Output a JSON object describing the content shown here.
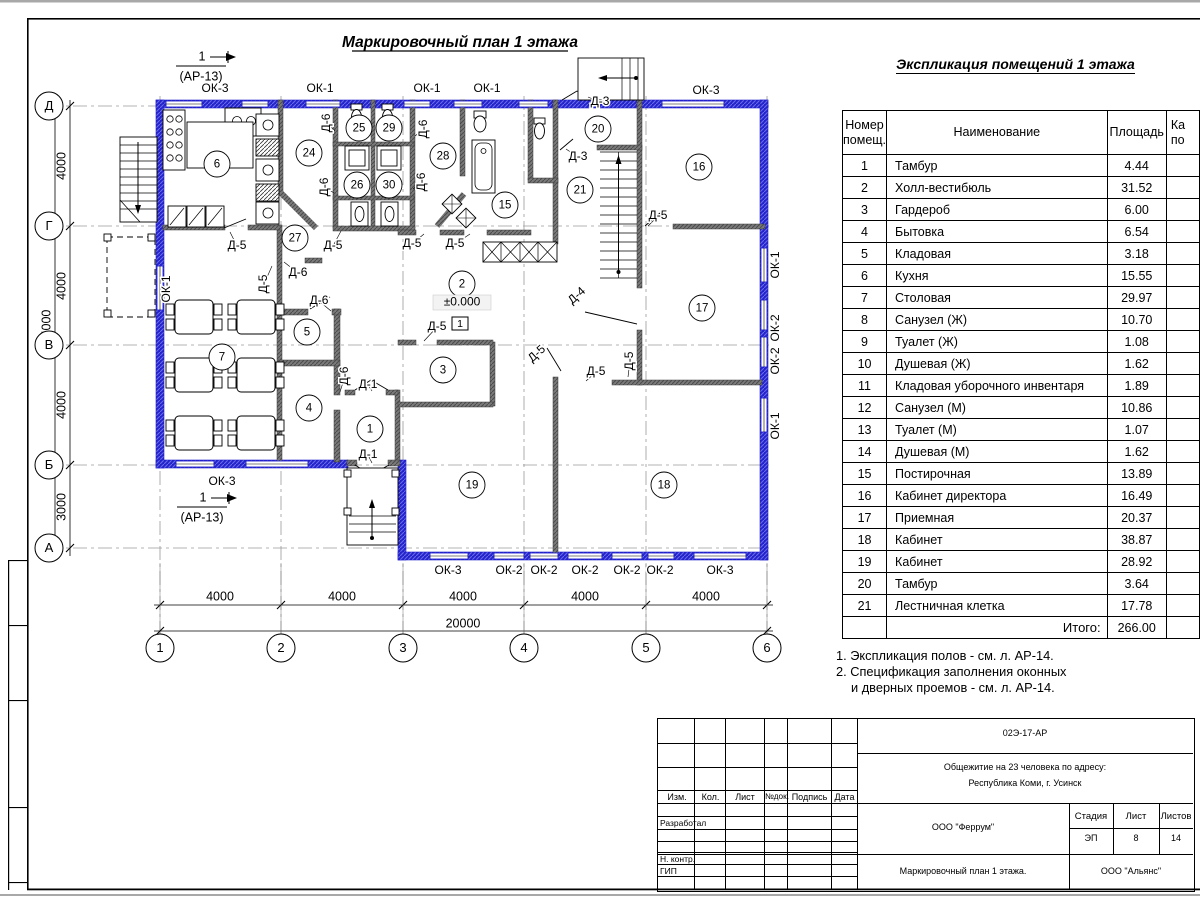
{
  "colors": {
    "wall_blue": "#2323cd",
    "wall_blue_light": "#6a6ae4",
    "wall_dark": "#7a7a7a",
    "wall_dark_line": "#4a4a4a",
    "line": "#000000",
    "axis": "#9a9a9a"
  },
  "plan": {
    "title": "Маркировочный план 1 этажа",
    "level_mark": "±0.000",
    "floor_mark": "1",
    "section_mark": {
      "num": "1",
      "ref": "(АР-13)"
    },
    "rooms": [
      {
        "n": "6",
        "x": 217,
        "y": 164
      },
      {
        "n": "24",
        "x": 309,
        "y": 153
      },
      {
        "n": "25",
        "x": 359,
        "y": 128
      },
      {
        "n": "29",
        "x": 389,
        "y": 128
      },
      {
        "n": "26",
        "x": 357,
        "y": 185
      },
      {
        "n": "30",
        "x": 389,
        "y": 185
      },
      {
        "n": "27",
        "x": 295,
        "y": 238
      },
      {
        "n": "28",
        "x": 443,
        "y": 156
      },
      {
        "n": "15",
        "x": 505,
        "y": 205
      },
      {
        "n": "2",
        "x": 462,
        "y": 284
      },
      {
        "n": "20",
        "x": 598,
        "y": 129
      },
      {
        "n": "21",
        "x": 580,
        "y": 190
      },
      {
        "n": "16",
        "x": 699,
        "y": 167
      },
      {
        "n": "17",
        "x": 702,
        "y": 308
      },
      {
        "n": "5",
        "x": 307,
        "y": 332
      },
      {
        "n": "7",
        "x": 222,
        "y": 357
      },
      {
        "n": "3",
        "x": 443,
        "y": 370
      },
      {
        "n": "4",
        "x": 309,
        "y": 408
      },
      {
        "n": "1",
        "x": 370,
        "y": 429
      },
      {
        "n": "19",
        "x": 472,
        "y": 485
      },
      {
        "n": "18",
        "x": 664,
        "y": 485
      }
    ],
    "labels": [
      {
        "t": "ОК-3",
        "x": 215,
        "y": 89
      },
      {
        "t": "ОК-1",
        "x": 320,
        "y": 89
      },
      {
        "t": "ОК-1",
        "x": 427,
        "y": 89
      },
      {
        "t": "ОК-1",
        "x": 487,
        "y": 89
      },
      {
        "t": "ОК-3",
        "x": 706,
        "y": 91
      },
      {
        "t": "ОК-1",
        "x": 167,
        "y": 289,
        "r": -90
      },
      {
        "t": "ОК-3",
        "x": 222,
        "y": 482
      },
      {
        "t": "ОК-3",
        "x": 448,
        "y": 571
      },
      {
        "t": "ОК-2",
        "x": 509,
        "y": 571
      },
      {
        "t": "ОК-2",
        "x": 544,
        "y": 571
      },
      {
        "t": "ОК-2",
        "x": 585,
        "y": 571
      },
      {
        "t": "ОК-2",
        "x": 627,
        "y": 571
      },
      {
        "t": "ОК-2",
        "x": 660,
        "y": 571
      },
      {
        "t": "ОК-3",
        "x": 720,
        "y": 571
      },
      {
        "t": "ОК-1",
        "x": 776,
        "y": 265,
        "r": -90
      },
      {
        "t": "ОК-2",
        "x": 776,
        "y": 328,
        "r": -90
      },
      {
        "t": "ОК-2",
        "x": 776,
        "y": 361,
        "r": -90
      },
      {
        "t": "ОК-1",
        "x": 776,
        "y": 426,
        "r": -90
      },
      {
        "t": "Д-6",
        "x": 327,
        "y": 123,
        "r": -90,
        "l": [
          335,
          131
        ]
      },
      {
        "t": "Д-6",
        "x": 325,
        "y": 187,
        "r": -90,
        "l": [
          334,
          193
        ]
      },
      {
        "t": "Д-6",
        "x": 424,
        "y": 129,
        "r": -90,
        "l": [
          415,
          136
        ]
      },
      {
        "t": "Д-6",
        "x": 422,
        "y": 182,
        "r": -90,
        "l": [
          413,
          189
        ]
      },
      {
        "t": "Д-5",
        "x": 237,
        "y": 246,
        "l": [
          230,
          232
        ]
      },
      {
        "t": "Д-5",
        "x": 264,
        "y": 284,
        "r": -90,
        "l": [
          272,
          266
        ]
      },
      {
        "t": "Д-5",
        "x": 333,
        "y": 246,
        "l": [
          341,
          231
        ]
      },
      {
        "t": "Д-5",
        "x": 412,
        "y": 244,
        "l": [
          424,
          234
        ]
      },
      {
        "t": "Д-5",
        "x": 455,
        "y": 244,
        "l": [
          470,
          234
        ]
      },
      {
        "t": "Д-6",
        "x": 298,
        "y": 273,
        "l": [
          284,
          262
        ]
      },
      {
        "t": "Д-6",
        "x": 319,
        "y": 301,
        "l": [
          331,
          311
        ]
      },
      {
        "t": "Д-6",
        "x": 345,
        "y": 376,
        "r": -90,
        "l": [
          340,
          392
        ]
      },
      {
        "t": "Д-1",
        "x": 368,
        "y": 385,
        "l": [
          372,
          391
        ]
      },
      {
        "t": "Д-1",
        "x": 368,
        "y": 455,
        "l": [
          372,
          463
        ]
      },
      {
        "t": "Д-3",
        "x": 600,
        "y": 102,
        "l": [
          588,
          97
        ]
      },
      {
        "t": "Д-3",
        "x": 578,
        "y": 157,
        "l": [
          566,
          149
        ]
      },
      {
        "t": "Д-5",
        "x": 658,
        "y": 216,
        "l": [
          648,
          226
        ]
      },
      {
        "t": "Д-4",
        "x": 577,
        "y": 296,
        "r": -42
      },
      {
        "t": "Д-5",
        "x": 437,
        "y": 327,
        "l": [
          424,
          341
        ]
      },
      {
        "t": "Д-5",
        "x": 537,
        "y": 354,
        "r": -42
      },
      {
        "t": "Д-5",
        "x": 596,
        "y": 372,
        "l": [
          586,
          381
        ]
      },
      {
        "t": "Д-5",
        "x": 630,
        "y": 361,
        "r": -90,
        "l": [
          628,
          377
        ]
      }
    ],
    "axes_rows": [
      {
        "t": "Д",
        "y": 106
      },
      {
        "t": "Г",
        "y": 226
      },
      {
        "t": "В",
        "y": 345
      },
      {
        "t": "Б",
        "y": 465
      },
      {
        "t": "А",
        "y": 548
      }
    ],
    "axes_cols": [
      {
        "t": "1",
        "x": 160
      },
      {
        "t": "2",
        "x": 281
      },
      {
        "t": "3",
        "x": 403
      },
      {
        "t": "4",
        "x": 524
      },
      {
        "t": "5",
        "x": 646
      },
      {
        "t": "6",
        "x": 767
      }
    ],
    "dims_left": [
      {
        "t": "4000",
        "y": 166
      },
      {
        "t": "4000",
        "y": 286
      },
      {
        "t": "4000",
        "y": 405
      },
      {
        "t": "3000",
        "y": 507
      }
    ],
    "dim_left_total": "15000",
    "dims_bottom": [
      {
        "t": "4000",
        "x": 220
      },
      {
        "t": "4000",
        "x": 342
      },
      {
        "t": "4000",
        "x": 463
      },
      {
        "t": "4000",
        "x": 585
      },
      {
        "t": "4000",
        "x": 706
      }
    ],
    "dim_bottom_total": "20000"
  },
  "explication": {
    "title": "Экспликация помещений 1 этажа",
    "headers": [
      [
        "Номер",
        "помещ."
      ],
      [
        "Наименование"
      ],
      [
        "Площадь"
      ],
      [
        "Ка",
        "по"
      ]
    ],
    "rows": [
      [
        "1",
        "Тамбур",
        "4.44"
      ],
      [
        "2",
        "Холл-вестибюль",
        "31.52"
      ],
      [
        "3",
        "Гардероб",
        "6.00"
      ],
      [
        "4",
        "Бытовка",
        "6.54"
      ],
      [
        "5",
        "Кладовая",
        "3.18"
      ],
      [
        "6",
        "Кухня",
        "15.55"
      ],
      [
        "7",
        "Столовая",
        "29.97"
      ],
      [
        "8",
        "Санузел (Ж)",
        "10.70"
      ],
      [
        "9",
        "Туалет (Ж)",
        "1.08"
      ],
      [
        "10",
        "Душевая (Ж)",
        "1.62"
      ],
      [
        "11",
        "Кладовая уборочного инвентаря",
        "1.89"
      ],
      [
        "12",
        "Санузел (М)",
        "10.86"
      ],
      [
        "13",
        "Туалет (М)",
        "1.07"
      ],
      [
        "14",
        "Душевая (М)",
        "1.62"
      ],
      [
        "15",
        "Постирочная",
        "13.89"
      ],
      [
        "16",
        "Кабинет директора",
        "16.49"
      ],
      [
        "17",
        "Приемная",
        "20.37"
      ],
      [
        "18",
        "Кабинет",
        "38.87"
      ],
      [
        "19",
        "Кабинет",
        "28.92"
      ],
      [
        "20",
        "Тамбур",
        "3.64"
      ],
      [
        "21",
        "Лестничная клетка",
        "17.78"
      ]
    ],
    "total_label": "Итого:",
    "total": "266.00"
  },
  "notes": {
    "line1": "1. Экспликация полов - см. л. АР-14.",
    "line2": "2. Спецификация заполнения оконных",
    "line3": "и дверных проемов - см. л. АР-14."
  },
  "titleblock": {
    "doc_code": "02Э-17-АР",
    "project_line1": "Общежитие на 23 человека по адресу:",
    "project_line2": "Республика Коми, г. Усинск",
    "org1": "ООО \"Феррум\"",
    "org2": "ООО \"Альянс\"",
    "sheet_title": "Маркировочный план 1 этажа.",
    "cols": [
      "Изм.",
      "Кол.",
      "Лист",
      "№док.",
      "Подпись",
      "Дата"
    ],
    "row_labels": [
      "Разработал",
      "Н. контр.",
      "ГИП"
    ],
    "stage_label": "Стадия",
    "stage": "ЭП",
    "sheet_label": "Лист",
    "sheet": "8",
    "sheets_label": "Листов",
    "sheets": "14"
  }
}
